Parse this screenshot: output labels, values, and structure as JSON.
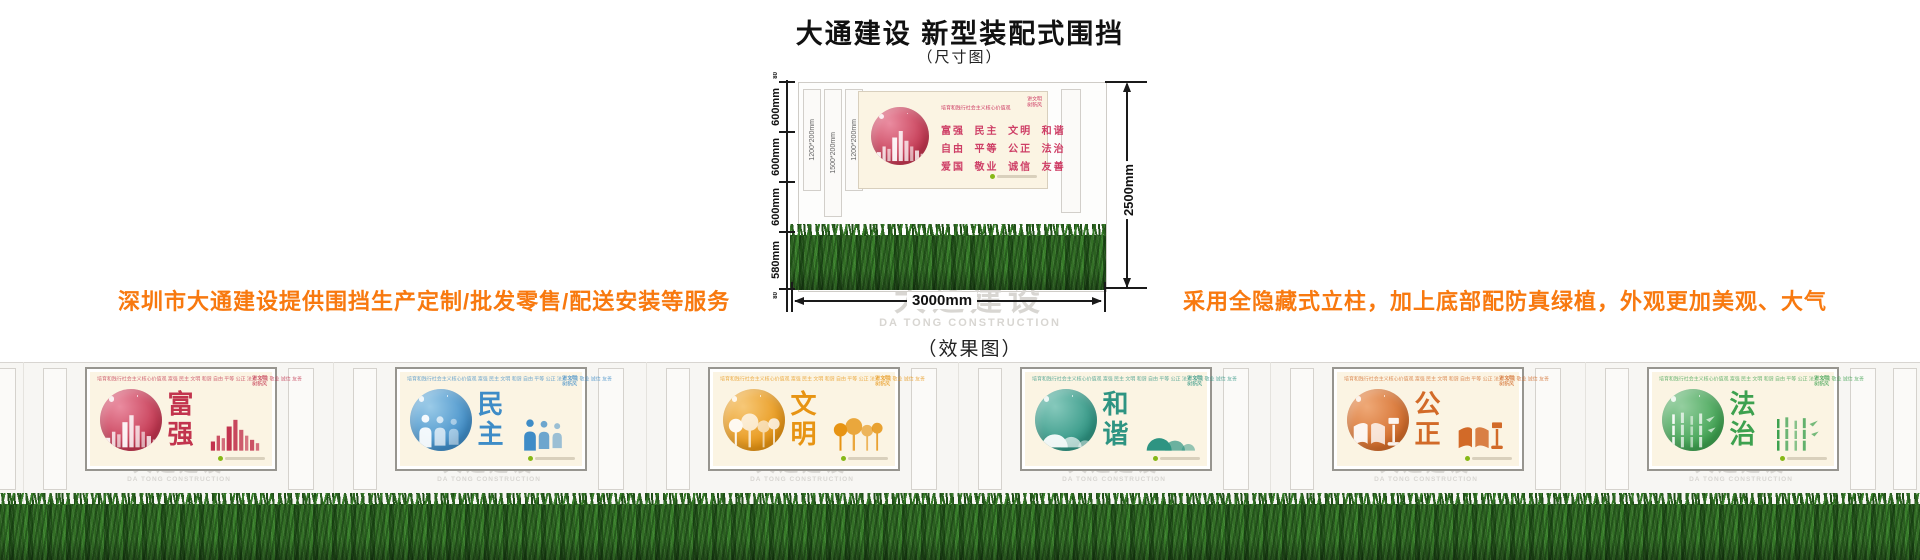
{
  "header": {
    "title": "大通建设 新型装配式围挡",
    "subtitle": "（尺寸图）"
  },
  "promos": {
    "left": "深圳市大通建设提供围挡生产定制/批发零售/配送安装等服务",
    "right": "采用全隐藏式立柱，加上底部配防真绿植，外观更加美观、大气"
  },
  "diagram": {
    "left_dims": [
      "600mm",
      "600mm",
      "600mm",
      "580mm"
    ],
    "left_dim_top": "80",
    "left_dim_bottom": "80",
    "post_labels": [
      "1200*200mm",
      "1500*200mm",
      "1200*200mm"
    ],
    "right_dim": "2500mm",
    "bottom_dim": "3000mm",
    "board": {
      "slogan_small": "培育和践行社会主义核心价值观",
      "badge_line1": "讲文明",
      "badge_line2": "树新风",
      "values_rows": [
        "富强  民主  文明  和谐",
        "自由  平等  公正  法治",
        "爱国  敬业  诚信  友善"
      ],
      "accent": "#ce3e66"
    },
    "caption": "（效果图）"
  },
  "watermark": {
    "cn": "大通建设",
    "en": "DA TONG CONSTRUCTION"
  },
  "panel_common": {
    "slogan_small": "培育和践行社会主义核心价值观  富强 民主 文明 和谐 自由 平等 公正 法治 爱国 敬业 诚信 友善",
    "badge_line1": "讲文明",
    "badge_line2": "树新风"
  },
  "panels": [
    {
      "label": "富强",
      "color": "#c2344e",
      "light": "#ea8ca0",
      "icon": "skyline-icon"
    },
    {
      "label": "民主",
      "color": "#3e8cc7",
      "light": "#9bcbe8",
      "icon": "people-icon"
    },
    {
      "label": "文明",
      "color": "#e79413",
      "light": "#f6c878",
      "icon": "trees-icon"
    },
    {
      "label": "和谐",
      "color": "#2e9482",
      "light": "#86c9bc",
      "icon": "mountains-icon"
    },
    {
      "label": "公正",
      "color": "#d26a28",
      "light": "#efa977",
      "icon": "book-gavel-icon"
    },
    {
      "label": "法治",
      "color": "#3da14f",
      "light": "#95cfa0",
      "icon": "bamboo-icon"
    }
  ],
  "colors": {
    "promo_orange": "#f8790f",
    "board_cream": "#fbf4e3",
    "wall": "#f7f6f3",
    "dimension_line": "#1a1a1a",
    "watermark_gray": "#d8d6d2",
    "grass_dark": "#1f4d17",
    "grass_light": "#377c29",
    "values_pink": "#ce3e66"
  }
}
